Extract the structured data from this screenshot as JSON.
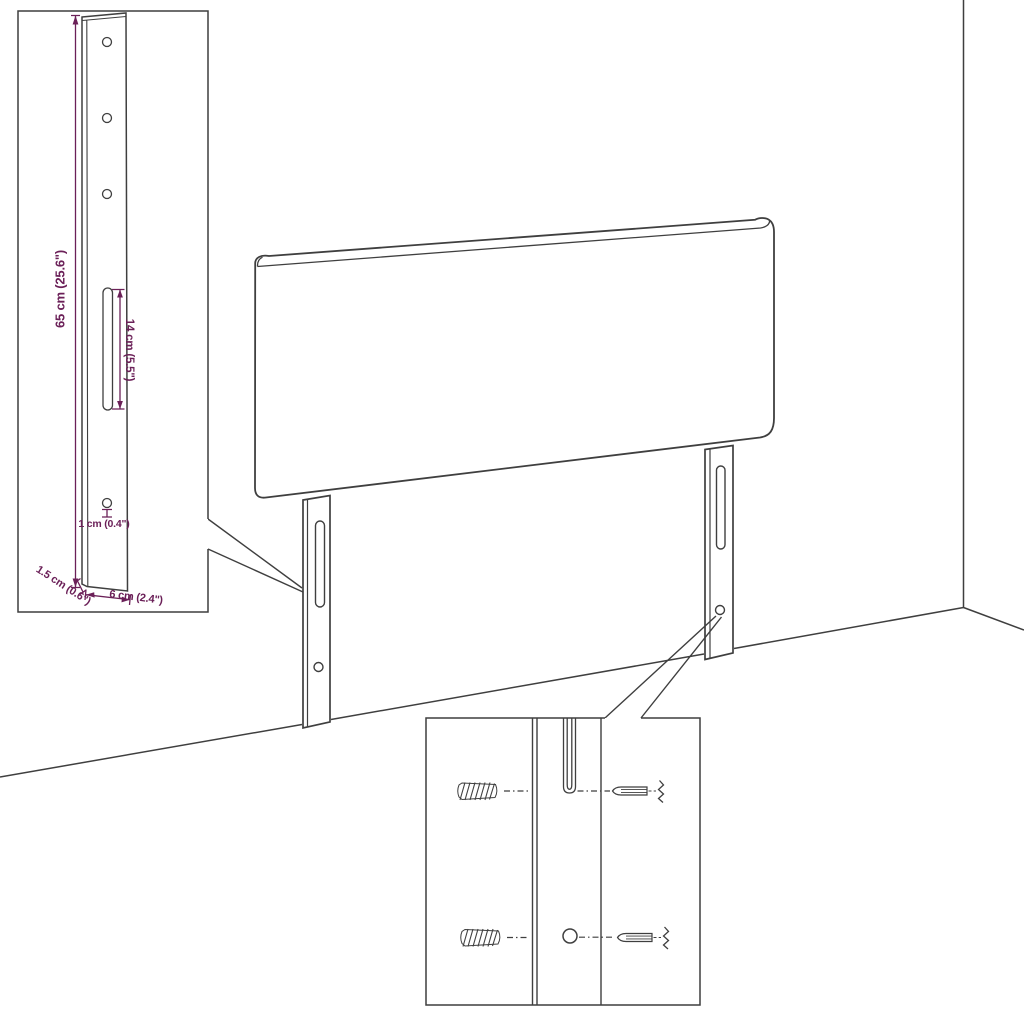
{
  "colors": {
    "background": "#ffffff",
    "line": "#3f3f3f",
    "accent": "#6b2058"
  },
  "bracket_inset": {
    "dim_height": "65 cm (25.6\")",
    "dim_slot_length": "14 cm (5.5\")",
    "dim_hole": "1 cm (0.4\")",
    "dim_depth": "1.5 cm (0.6\")",
    "dim_width": "6 cm (2.4\")"
  }
}
